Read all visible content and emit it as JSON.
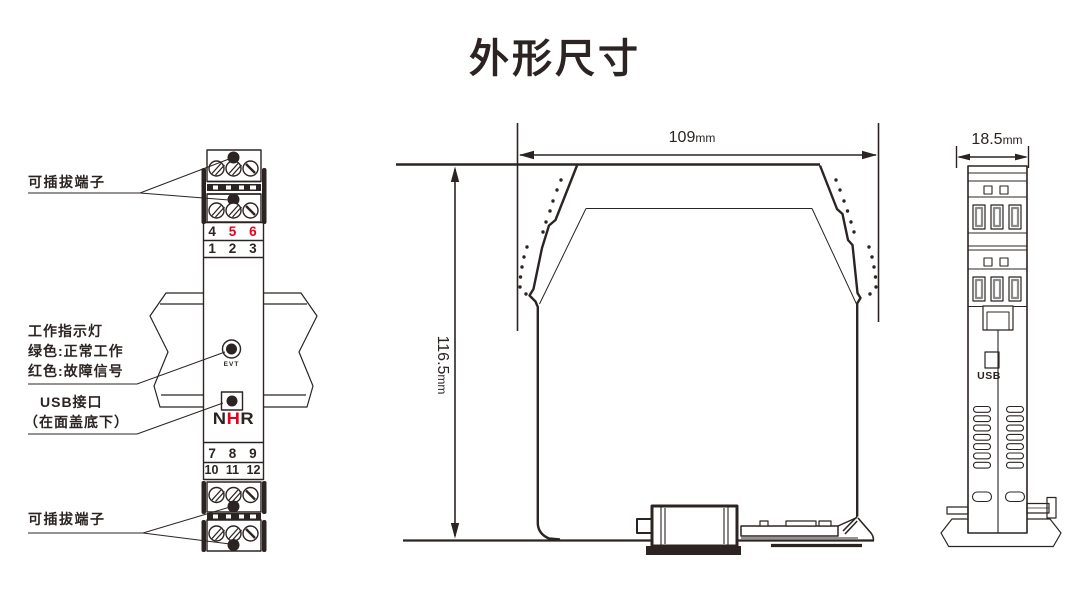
{
  "title": "外形尺寸",
  "colors": {
    "line": "#2b2422",
    "red": "#e60019",
    "slot_gray": "#8a8a8a"
  },
  "front_view": {
    "callouts": {
      "pluggable_top": "可插拔端子",
      "indicator_line1": "工作指示灯",
      "indicator_line2": "绿色:正常工作",
      "indicator_line3": "红色:故障信号",
      "usb_line1": "USB接口",
      "usb_line2": "（在面盖底下）",
      "pluggable_bottom": "可插拔端子"
    },
    "terminals": {
      "top_row_upper": [
        "4",
        "5",
        "6"
      ],
      "top_row_lower": [
        "1",
        "2",
        "3"
      ],
      "bottom_row_upper": [
        "7",
        "8",
        "9"
      ],
      "bottom_row_lower": [
        "10",
        "11",
        "12"
      ]
    },
    "indicator_label": "EVT",
    "logo": {
      "letter1": "N",
      "letter2": "H",
      "letter3": "R"
    }
  },
  "dimensions": {
    "width_value": "109",
    "height_value": "116.5",
    "depth_value": "18.5",
    "unit": "mm"
  },
  "side_view": {
    "usb_label": "USB"
  }
}
